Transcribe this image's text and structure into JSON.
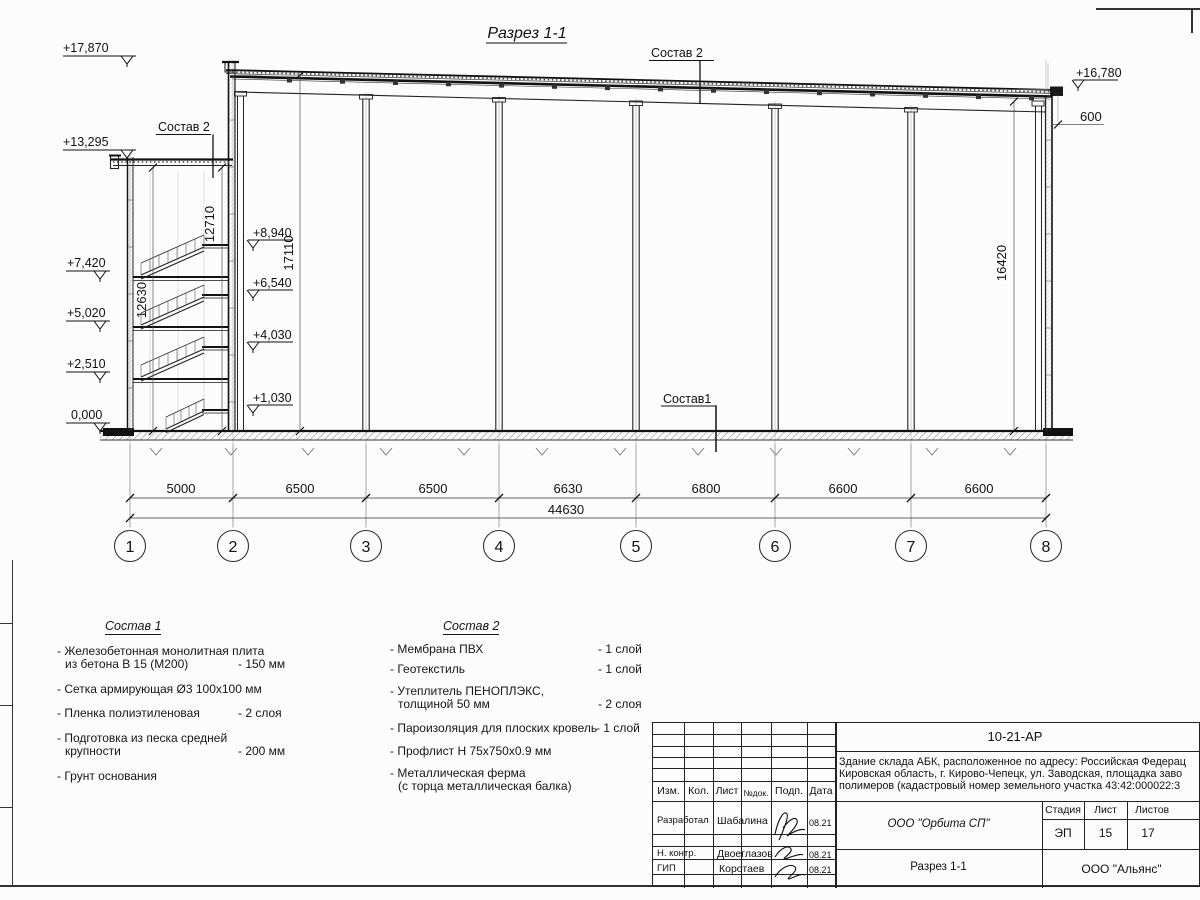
{
  "section": {
    "title": "Разрез 1-1",
    "composition2_label_top": "Состав 2",
    "composition2_label_left": "Состав 2",
    "composition1_label": "Состав1",
    "lev_17870": "+17,870",
    "lev_13295": "+13,295",
    "lev_7420": "+7,420",
    "lev_5020": "+5,020",
    "lev_2510": "+2,510",
    "lev_0000": "0,000",
    "lev_8940": "+8,940",
    "lev_6540": "+6,540",
    "lev_4030": "+4,030",
    "lev_1030": "+1,030",
    "lev_16780": "+16,780",
    "dim_600": "600",
    "dim_12710": "12710",
    "dim_12630": "12630",
    "dim_17110": "17110",
    "dim_16420": "16420",
    "dim_spans": [
      "5000",
      "6500",
      "6500",
      "6630",
      "6800",
      "6600",
      "6600"
    ],
    "dim_total": "44630",
    "axes": [
      "1",
      "2",
      "3",
      "4",
      "5",
      "6",
      "7",
      "8"
    ]
  },
  "sostav1": {
    "title": "Состав 1",
    "i0l1": "- Железобетонная  монолитная плита",
    "i0l2": "из бетона В 15 (М200)",
    "i0v": "- 150 мм",
    "i1l1": "- Сетка армирующая Ø3 100х100 мм",
    "i2l1": "- Пленка полиэтиленовая",
    "i2v": "-  2 слоя",
    "i3l1": "- Подготовка из песка средней",
    "i3l2": "крупности",
    "i3v": "- 200 мм",
    "i4l1": "- Грунт основания"
  },
  "sostav2": {
    "title": "Состав 2",
    "i0l1": "- Мембрана ПВХ",
    "i0v": "- 1 слой",
    "i1l1": "- Геотекстиль",
    "i1v": "- 1 слой",
    "i2l1": "- Утеплитель ПЕНОПЛЭКС,",
    "i2l2": "толщиной 50 мм",
    "i2v": "- 2 слоя",
    "i3l1": "- Пароизоляция для плоских кровель",
    "i3v": "- 1 слой",
    "i4l1": "- Профлист Н 75х750х0.9 мм",
    "i5l1": "- Металлическая ферма",
    "i5l2": "(с торца металлическая балка)"
  },
  "titleblock": {
    "doc_number": "10-21-АР",
    "desc_l1": "Здание склада АБК, расположенное по адресу: Российская Федерац",
    "desc_l2": "Кировская область, г. Кирово-Чепецк, ул. Заводская, площадка заво",
    "desc_l3": "полимеров (кадастровый номер земельного участка 43:42:000022:3",
    "col_izm": "Изм.",
    "col_kol": "Кол.",
    "col_list": "Лист",
    "col_ndok": "№док.",
    "col_podp": "Подп.",
    "col_data": "Дата",
    "row1_role": "Разработал",
    "row1_name": "Шабалина",
    "row1_date": "08.21",
    "row2_role": "Н. контр.",
    "row2_name": "Двоеглазов",
    "row2_date": "08.21",
    "row3_role": "ГИП",
    "row3_name": "Коротаев",
    "row3_date": "08.21",
    "org": "ООО \"Орбита СП\"",
    "sheet_title": "Разрез 1-1",
    "stage_label": "Стадия",
    "sheet_label": "Лист",
    "sheets_label": "Листов",
    "stage": "ЭП",
    "sheet_no": "15",
    "sheets_total": "17",
    "company": "ООО \"Альянс\""
  }
}
